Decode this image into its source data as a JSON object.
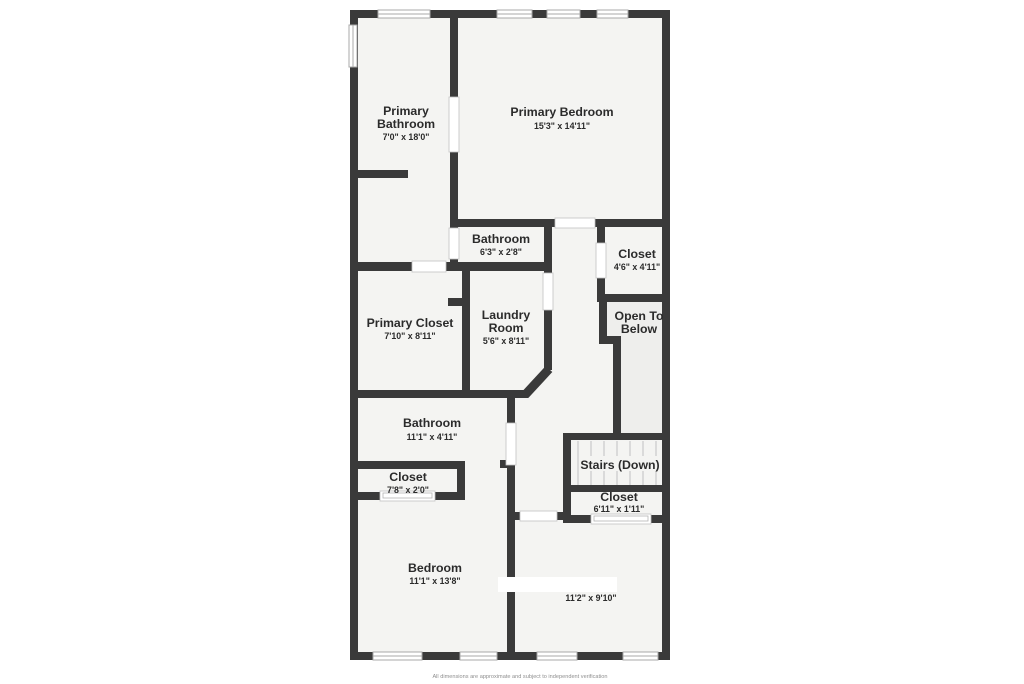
{
  "floorplan": {
    "footer": "All dimensions are approximate and subject to independent verification",
    "colors": {
      "wall": "#3a3a3a",
      "floor": "#f4f4f2",
      "text": "#2b2b2b"
    },
    "rooms": [
      {
        "id": "primary-bathroom",
        "name_lines": [
          "Primary",
          "Bathroom"
        ],
        "dims": "7'0\" x 18'0\""
      },
      {
        "id": "primary-bedroom",
        "name_lines": [
          "Primary Bedroom"
        ],
        "dims": "15'3\" x 14'11\""
      },
      {
        "id": "bathroom-small",
        "name_lines": [
          "Bathroom"
        ],
        "dims": "6'3\" x 2'8\""
      },
      {
        "id": "closet-upper",
        "name_lines": [
          "Closet"
        ],
        "dims": "4'6\" x 4'11\""
      },
      {
        "id": "open-to-below",
        "name_lines": [
          "Open To",
          "Below"
        ],
        "dims": ""
      },
      {
        "id": "primary-closet",
        "name_lines": [
          "Primary Closet"
        ],
        "dims": "7'10\" x 8'11\""
      },
      {
        "id": "laundry-room",
        "name_lines": [
          "Laundry",
          "Room"
        ],
        "dims": "5'6\" x 8'11\""
      },
      {
        "id": "bathroom-middle",
        "name_lines": [
          "Bathroom"
        ],
        "dims": "11'1\" x 4'11\""
      },
      {
        "id": "closet-middle",
        "name_lines": [
          "Closet"
        ],
        "dims": "7'8\" x 2'0\""
      },
      {
        "id": "stairs",
        "name_lines": [
          "Stairs (Down)"
        ],
        "dims": ""
      },
      {
        "id": "closet-stairs",
        "name_lines": [
          "Closet"
        ],
        "dims": "6'11\" x 1'11\""
      },
      {
        "id": "bedroom",
        "name_lines": [
          "Bedroom"
        ],
        "dims": "11'1\" x 13'8\""
      },
      {
        "id": "room-unlabeled",
        "name_lines": [],
        "dims": "11'2\" x 9'10\""
      }
    ]
  }
}
